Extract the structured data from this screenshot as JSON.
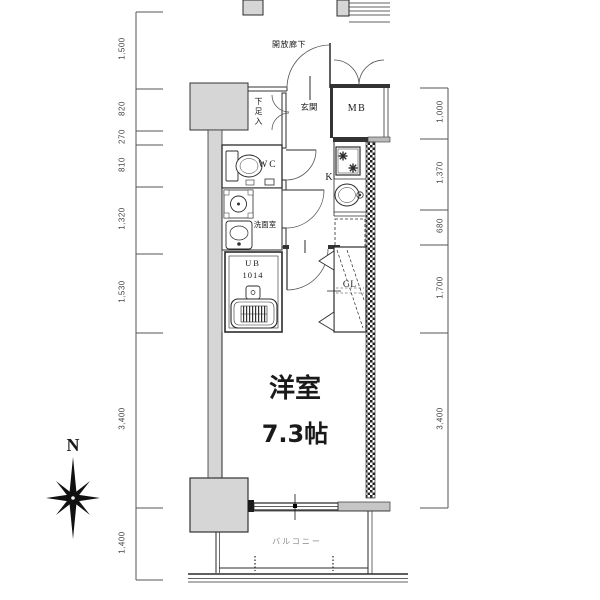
{
  "plan": {
    "rooms": {
      "main_room_name": "洋室",
      "main_room_size": "7.3帖",
      "entrance": "玄関",
      "open_corridor": "開放廊下",
      "shoe_cabinet": "下足入",
      "toilet": "WC",
      "washroom": "洗面室",
      "bath_label": "UB",
      "bath_size": "1014",
      "kitchen": "K",
      "meter_box": "MB",
      "closet": "CL",
      "balcony": "バルコニー"
    },
    "compass_north": "N",
    "dimensions": {
      "left": [
        "1,500",
        "820",
        "270",
        "810",
        "1,320",
        "1,530",
        "3,400",
        "1,400"
      ],
      "right": [
        "1,000",
        "1,370",
        "680",
        "1,700",
        "3,400"
      ]
    },
    "colors": {
      "wall_gray": "#d6d6d6",
      "line": "#2b2b2b",
      "balcony_text": "#8a8a8a"
    }
  }
}
